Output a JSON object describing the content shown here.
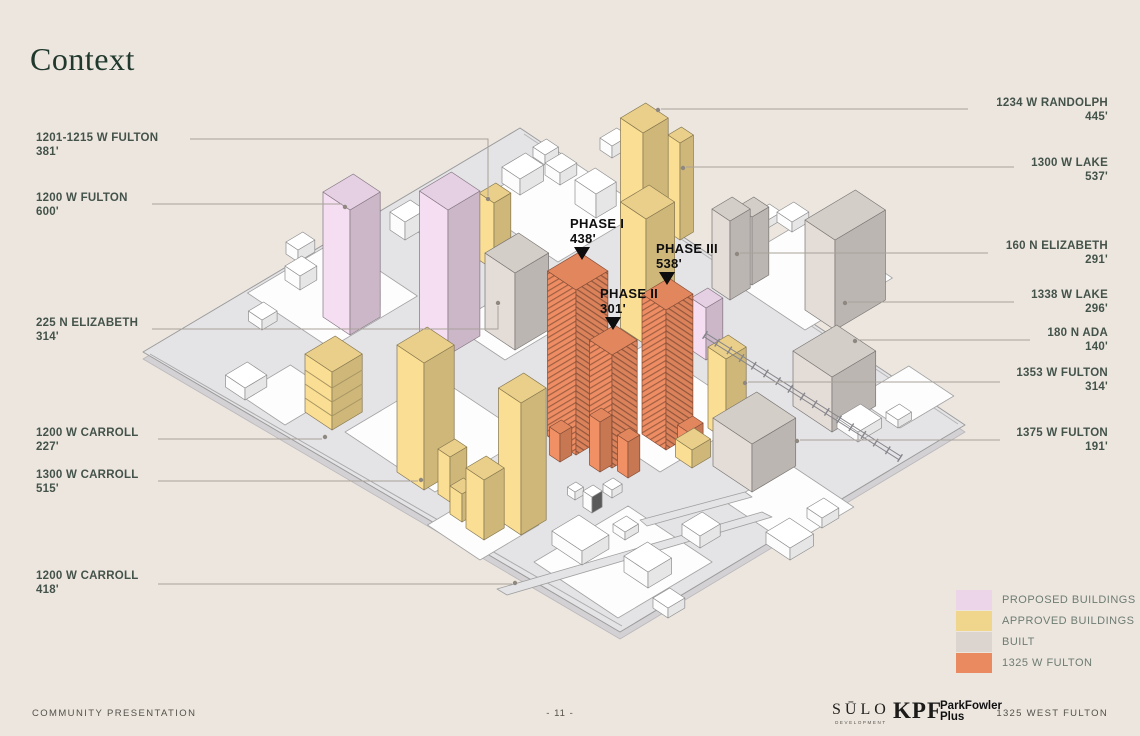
{
  "title": "Context",
  "left_labels": [
    {
      "name": "1201-1215 W FULTON",
      "height": "381'"
    },
    {
      "name": "1200 W FULTON",
      "height": "600'"
    },
    {
      "name": "225 N ELIZABETH",
      "height": "314'"
    },
    {
      "name": "1200 W CARROLL",
      "height": "227'"
    },
    {
      "name": "1300 W CARROLL",
      "height": "515'"
    },
    {
      "name": "1200 W CARROLL",
      "height": "418'"
    }
  ],
  "right_labels": [
    {
      "name": "1234 W RANDOLPH",
      "height": "445'"
    },
    {
      "name": "1300 W LAKE",
      "height": "537'"
    },
    {
      "name": "160 N ELIZABETH",
      "height": "291'"
    },
    {
      "name": "1338 W LAKE",
      "height": "296'"
    },
    {
      "name": "180 N ADA",
      "height": "140'"
    },
    {
      "name": "1353 W FULTON",
      "height": "314'"
    },
    {
      "name": "1375 W FULTON",
      "height": "191'"
    }
  ],
  "phase_labels": [
    {
      "name": "PHASE I",
      "height": "438'"
    },
    {
      "name": "PHASE II",
      "height": "301'"
    },
    {
      "name": "PHASE III",
      "height": "538'"
    }
  ],
  "legend": {
    "items": [
      {
        "label": "PROPOSED BUILDINGS",
        "color": "#ecd5e9"
      },
      {
        "label": "APPROVED BUILDINGS",
        "color": "#f0d58d"
      },
      {
        "label": "BUILT",
        "color": "#dbd4cf"
      },
      {
        "label": "1325 W FULTON",
        "color": "#e98a61"
      }
    ]
  },
  "footer": {
    "left": "COMMUNITY PRESENTATION",
    "page": "- 11 -",
    "brands": [
      {
        "name": "SŪLO",
        "tagline": "DEVELOPMENT"
      },
      {
        "name": "KPF"
      },
      {
        "name": "ParkFowler",
        "name2": "Plus"
      }
    ],
    "right": "1325 WEST FULTON"
  },
  "colors": {
    "background": "#ece6df",
    "title": "#21382d",
    "label_text": "#44534a",
    "leader_line": "#a9a29b",
    "ground": "#e4e3e6",
    "white_building": "#ffffff"
  }
}
